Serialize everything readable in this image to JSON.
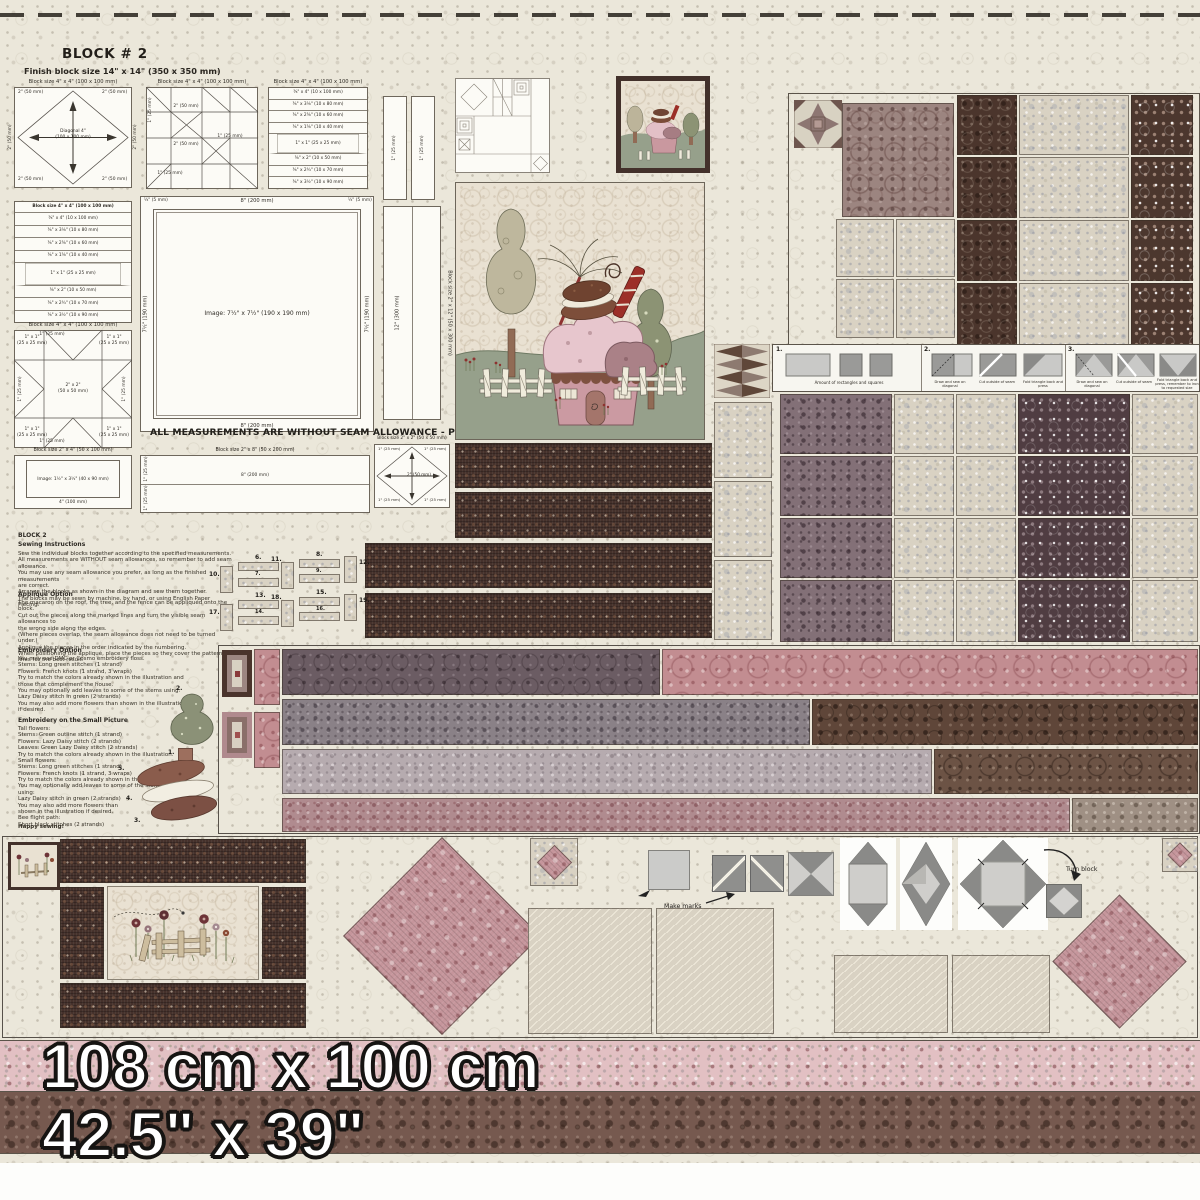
{
  "header": {
    "title": "BLOCK # 2",
    "subtitle": "Finish block size 14\" x 14\"   (350 x 350 mm)"
  },
  "labels": {
    "block_4x4": "Block size 4\" x 4\"   (100 x 100 mm)",
    "block_2x12": "Block size 2\" x 12\"   (50 x 300 mm)",
    "block_2x4": "Block size 2\" x 4\"   (50 x 100 mm)",
    "block_2x8": "Block size 2\" x 8\"   (50 x 200 mm)",
    "block_2x2": "Block size 2\" x 2\"   (50 x 50 mm)",
    "diagonal": "Diagonal 4\"",
    "diagonal_mm": "(100 x 100 mm)",
    "image_big": "Image:  7½\" x 7½\"   (190 x 190 mm)",
    "image_small": "Image:  1½\" x 3½\"   (40 x 90 mm)",
    "len_12": "12\" (300 mm)",
    "len_8": "8\" (200 mm)",
    "len_7h": "7½\" (190 mm)",
    "len_4": "4\" (100 mm)",
    "len_2": "2\" (50 mm)",
    "len_1": "1\" (25 mm)",
    "len_q": "¼\" (5 mm)",
    "sq_2x2": "2\" x 2\"",
    "sq_2x2_mm": "(50 x 50 mm)",
    "sq_1x1": "1\" x 1\"",
    "sq_1x1_mm": "(25 x 25 mm)",
    "seam_notice": "ALL MEASUREMENTS ARE WITHOUT SEAM ALLOWANCE - PLEASE ADD SEAM ALLOWANCE",
    "logcabin_rows": [
      "⅜\" x 4\"  (10 x 100 mm)",
      "⅜\" x 3⅛\"  (10 x 80 mm)",
      "⅜\" x 2⅜\"  (10 x 60 mm)",
      "⅜\" x 1⅝\"  (10 x 40 mm)",
      "1\" x 1\"  (25 x 25 mm)",
      "⅜\" x 2\"  (10 x 50 mm)",
      "⅜\" x 2¾\"  (10 x 70 mm)",
      "⅜\" x 3½\"  (10 x 90 mm)"
    ]
  },
  "instructions": {
    "block_title": "BLOCK 2",
    "s1_heading": "Sewing Instructions",
    "s1_body": "Sew the individual blocks together according to the specified measurements.\nAll measurements are WITHOUT seam allowances, so remember to add seam allowance.\nYou may use any seam allowance you prefer, as long as the finished measurements\nare correct.\nArrange the blocks as shown in the diagram and sew them together.\nThe blocks may be sewn by machine, by hand, or using English Paper Piecing.",
    "s2_heading": "Appliqué Option",
    "s2_body": "The macaron on the roof, the tree, and the fence can be appliquéd onto the block.\nCut out the pieces along the marked lines and turn the visible seam allowances to\nthe wrong side along the edges.\n(Where pieces overlap, the seam allowance does not need to be turned under.)\nAppliqué the pieces in the order indicated by the numbering.\nWhen positioning the appliqué, place the pieces so they cover the pattern\nlines for the best result.",
    "s3_heading": "Embroidery Option",
    "s3_body": "You may use DMC or Cosmo embroidery floss.\nStems: Long green stitches (1 strand)\nFlowers: French knots (1 strand, 3 wraps)\nTry to match the colors already shown in the illustration and\nthose that complement the house.\nYou may optionally add leaves to some of the stems using:\nLazy Daisy stitch in green (2 strands)\nYou may also add more flowers than shown in the illustration\nif desired.",
    "s4_heading": "Embroidery on the Small Picture",
    "s4_body": "Tall flowers:\nStems: Green outline stitch (1 strand)\nFlowers: Lazy Daisy stitch (2 strands)\nLeaves: Green Lazy Daisy stitch (2 strands)\nTry to match the colors already shown in the illustration.\nSmall flowers:\nStems: Long green stitches (1 strand)\nFlowers: French knots (1 strand, 3 wraps)\nTry to match the colors already shown in the illustration.\nYou may optionally add leaves to some of the stems using:\nLazy Daisy stitch in green (2 strands)\nYou may also add more flowers than\nshown in the illustration if desired.\nBee flight path:\nShort black stitches (2 strands)",
    "closing": "Happy sewing!"
  },
  "steps": {
    "n1": "1.",
    "n2": "2.",
    "n3": "3.",
    "c1": "Amount of rectangles and squares",
    "c2a": "Draw and sew on diagonal",
    "c2b": "Cut outside of seam",
    "c2c": "Fold triangle back and press",
    "c3a": "Draw and sew on diagonal",
    "c3b": "Cut outside of seam",
    "c3c": "Fold triangle back and press, remember to iron to requested size"
  },
  "fence": {
    "n6": "6.",
    "n7": "7.",
    "n8": "8.",
    "n9": "9.",
    "n10": "10.",
    "n11": "11.",
    "n12": "12.",
    "n13": "13.",
    "n14": "14.",
    "n15": "15.",
    "n16": "16.",
    "n17": "17.",
    "n18": "18.",
    "n19": "19."
  },
  "applique_numbers": {
    "n1": "1.",
    "n2": "2.",
    "n3": "3.",
    "n4": "4.",
    "n5": "5."
  },
  "notes": {
    "make_marks": "Make marks",
    "turn_block": "Turn block"
  },
  "dimensions": {
    "metric": "108 cm x 100 cm",
    "imperial": "42.5\" x 39\""
  },
  "palette": {
    "cream": "#ebe7da",
    "dark_brown": "#45312b",
    "mauve": "#9c8580",
    "beige": "#d9d2c3",
    "pink": "#c28d91",
    "plum": "#6b5c63",
    "green": "#8c9374",
    "red_accent": "#9c2f28"
  }
}
